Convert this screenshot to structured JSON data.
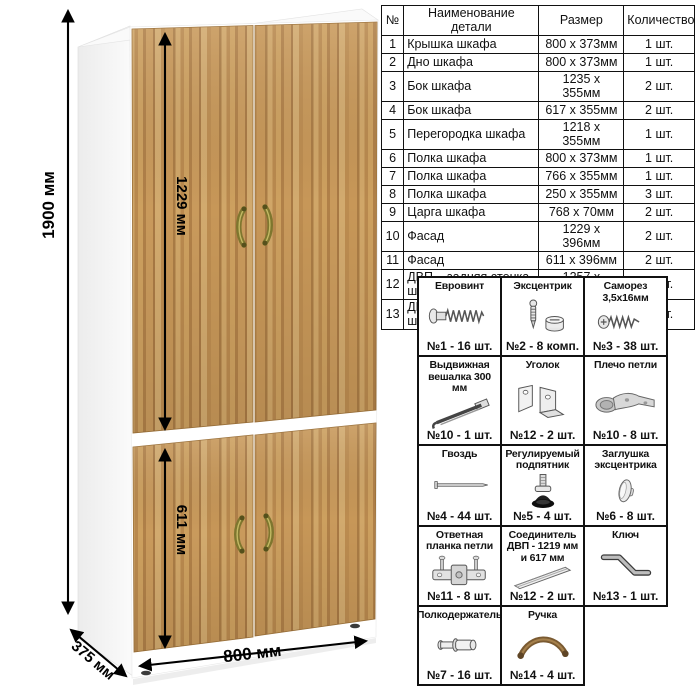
{
  "dimensions": {
    "height": "1900 мм",
    "upper_section_height": "1229 мм",
    "lower_section_height": "611 мм",
    "width": "800 мм",
    "depth": "375 мм"
  },
  "parts_table": {
    "headers": [
      "№",
      "Наименование детали",
      "Размер",
      "Количество"
    ],
    "rows": [
      [
        "1",
        "Крышка шкафа",
        "800 x 373мм",
        "1 шт."
      ],
      [
        "2",
        "Дно шкафа",
        "800 x 373мм",
        "1 шт."
      ],
      [
        "3",
        "Бок шкафа",
        "1235 x 355мм",
        "2 шт."
      ],
      [
        "4",
        "Бок шкафа",
        "617 x 355мм",
        "2 шт."
      ],
      [
        "5",
        "Перегородка шкафа",
        "1218 x 355мм",
        "1 шт."
      ],
      [
        "6",
        "Полка шкафа",
        "800 x 373мм",
        "1 шт."
      ],
      [
        "7",
        "Полка шкафа",
        "766 x 355мм",
        "1 шт."
      ],
      [
        "8",
        "Полка шкафа",
        "250 x 355мм",
        "3 шт."
      ],
      [
        "9",
        "Царга шкафа",
        "768 x 70мм",
        "2 шт."
      ],
      [
        "10",
        "Фасад",
        "1229 x 396мм",
        "2 шт."
      ],
      [
        "11",
        "Фасад",
        "611 x 396мм",
        "2 шт."
      ],
      [
        "12",
        "ДВП – задняя стенка шкафа",
        "1257 x 396мм",
        "2 шт."
      ],
      [
        "13",
        "ДВП – задняя стенка шкафа",
        "639 x 396мм",
        "2 шт."
      ]
    ]
  },
  "hardware": {
    "items": [
      {
        "name": "Евровинт",
        "count": "№1 - 16 шт.",
        "icon": "confirmat-screw-icon"
      },
      {
        "name": "Эксцентрик",
        "count": "№2 - 8 комп.",
        "icon": "eccentric-cam-icon"
      },
      {
        "name": "Саморез 3,5х16мм",
        "count": "№3 - 38 шт.",
        "icon": "screw-icon"
      },
      {
        "name": "Выдвижная вешалка 300 мм",
        "count": "№10 - 1 шт.",
        "icon": "pullout-hanger-icon"
      },
      {
        "name": "Уголок",
        "count": "№12 - 2 шт.",
        "icon": "corner-bracket-icon"
      },
      {
        "name": "Плечо петли",
        "count": "№10 - 8 шт.",
        "icon": "hinge-arm-icon"
      },
      {
        "name": "Гвоздь",
        "count": "№4 - 44 шт.",
        "icon": "nail-icon"
      },
      {
        "name": "Регулируемый подпятник",
        "count": "№5 - 4 шт.",
        "icon": "adjustable-foot-icon"
      },
      {
        "name": "Заглушка эксцентрика",
        "count": "№6 - 8 шт.",
        "icon": "cam-cap-icon"
      },
      {
        "name": "Ответная планка петли",
        "count": "№11 - 8 шт.",
        "icon": "hinge-plate-icon"
      },
      {
        "name": "Соединитель ДВП - 1219 мм и 617 мм",
        "count": "№12 - 2 шт.",
        "icon": "hdf-connector-icon"
      },
      {
        "name": "Ключ",
        "count": "№13 - 1 шт.",
        "icon": "key-icon"
      },
      {
        "name": "Полкодержатель",
        "count": "№7 - 16 шт.",
        "icon": "shelf-pin-icon"
      },
      {
        "name": "Ручка",
        "count": "№14 - 4 шт.",
        "icon": "bow-handle-icon"
      }
    ]
  },
  "colors": {
    "wood_base": "#c4965a",
    "wood_light": "#d2aa6e",
    "wood_dark": "#a87944",
    "handle": "#7e762e",
    "carcass": "#ffffff",
    "dimension_line": "#000000",
    "table_border": "#111111"
  }
}
